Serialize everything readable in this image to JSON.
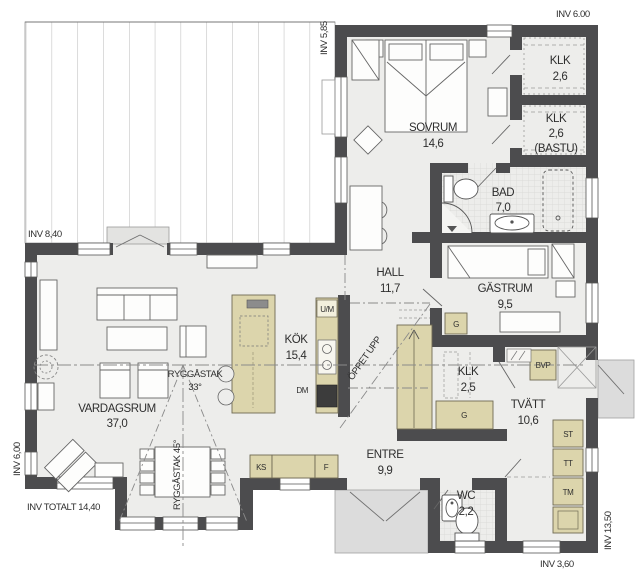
{
  "plan": {
    "colors": {
      "wall": "#4c4c4e",
      "floor": "#ededeb",
      "cabinet_beige": "#dcd5ac",
      "porch_gray": "#dcdcdc",
      "tile_line": "#d6d6d4"
    },
    "rooms": [
      {
        "id": "vardagsrum",
        "name": "VARDAGSRUM",
        "area": "37,0"
      },
      {
        "id": "kok",
        "name": "KÖK",
        "area": "15,4"
      },
      {
        "id": "sovrum",
        "name": "SOVRUM",
        "area": "14,6"
      },
      {
        "id": "klk1",
        "name": "KLK",
        "area": "2,6"
      },
      {
        "id": "klk2",
        "name": "KLK",
        "area": "2,6",
        "note": "(BASTU)"
      },
      {
        "id": "bad",
        "name": "BAD",
        "area": "7,0"
      },
      {
        "id": "hall",
        "name": "HALL",
        "area": "11,7"
      },
      {
        "id": "gastrum",
        "name": "GÄSTRUM",
        "area": "9,5"
      },
      {
        "id": "klk3",
        "name": "KLK",
        "area": "2,5"
      },
      {
        "id": "tvatt",
        "name": "TVÄTT",
        "area": "10,6"
      },
      {
        "id": "entre",
        "name": "ENTRE",
        "area": "9,9"
      },
      {
        "id": "wc",
        "name": "WC",
        "area": "2,2"
      }
    ],
    "dimensions": {
      "top_right": "INV 6.00",
      "top_mid_vertical": "INV 5,85",
      "deck_left": "INV 8,40",
      "left_vertical": "INV 6,00",
      "bottom_left_total": "INV TOTALT 14,40",
      "right_vertical": "INV 13,50",
      "bottom_right": "INV 3,60"
    },
    "annotations": {
      "ridge_main": "RYGGÅSTAK",
      "ridge_main_angle": "33°",
      "ridge_bay": "RYGGÅSTAK 45°",
      "open_above": "ÖPPET UPP"
    },
    "appliances": {
      "um": "U/M",
      "dm": "DM",
      "ks": "KS",
      "f": "F",
      "g_hall": "G",
      "g_klk": "G",
      "bvp": "BVP",
      "st": "ST",
      "tt": "TT",
      "tm": "TM"
    }
  }
}
